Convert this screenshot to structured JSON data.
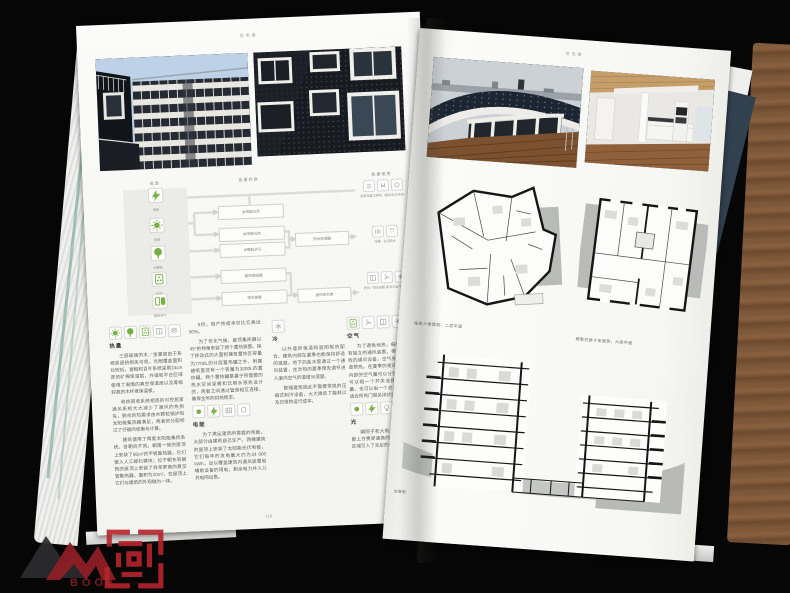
{
  "colors": {
    "accent_green": "#76b043",
    "seal_red": "#b5252b",
    "cover_navy": "#32414f",
    "wood_brown": "#7b5638",
    "plan_gray": "#b8bbb8"
  },
  "watermark": {
    "logo_text": "BOOK"
  },
  "book": {
    "left_page": {
      "header": "住宅楼",
      "page_number": "116",
      "photos": [
        {
          "name": "courtyard-facade-photo"
        },
        {
          "name": "dark-facade-photo"
        }
      ],
      "diagram": {
        "headers": [
          "能源",
          "能量转换",
          "能量使用"
        ],
        "sources": [
          {
            "icon": "lightning",
            "label": "电网"
          },
          {
            "icon": "sun",
            "label": "太阳"
          },
          {
            "icon": "tree",
            "label": "木颗粒"
          },
          {
            "icon": "pellet",
            "label": "地热"
          },
          {
            "icon": "exhaust",
            "label": "废弃空气"
          }
        ],
        "converters": [
          "太阳能光伏",
          "太阳能光热",
          "木颗粒炉子",
          "废热回收器",
          "排风装置"
        ],
        "storages": [
          "热水存储器",
          "通风热交换"
        ],
        "usages": [
          {
            "icons": [
              "grid-outline",
              "plug-outline",
              "circle-outline"
            ],
            "caption": "家用电器与照明（剩余电力并网）"
          },
          {
            "icons": [
              "radiator-outline",
              "shower-outline"
            ],
            "caption": "采暖 · 生活热水"
          },
          {
            "icons": [
              "window-outline",
              "fan-outline",
              "star-outline"
            ],
            "caption": "进风／排风装置 新风与废气热交换"
          }
        ]
      },
      "columns": [
        {
          "sections": [
            {
              "icons": [
                "sun",
                "tree",
                "pellet",
                "window-outline",
                "layers-outline"
              ],
              "title": "热量",
              "paragraphs": [
                "三层玻璃的木／金属窗由于系统原因热损失可观，光照覆盖面积比较低，窗框和百叶系统采用24cm厚的矿棉保温层，外墙和平台区域使用了周围的真空保温层以及等级较高的木纤维保温板。",
                "和热回收系统相连的可控居室通风系统大大减少了通风的热损失，剩余的热需求由木颗粒锅炉和太阳能集热器满足，两者的分配经过了仔细的权衡与计算。",
                "建筑使用了两套太阳能集热系统，各朝向不同。朝南一侧的屋顶上安装了95m²的平板集热器，它们嵌入人工蛭石模块；位于朝东和朝西的屋顶上安装了效率更高的真空管集热器，面积为20m²，在屋顶上它们与建筑的外观融为一体。"
              ]
            }
          ]
        },
        {
          "sections": [
            {
              "icons": [],
              "title": "",
              "paragraphs": [
                "5份，但产热成本仅比它高出50%。",
                "为了优化气候，屋顶集热器以45°的倾角安装了两个蓄热装置。除了移动式的大面积建筑蓄热区容量为7700L的分层蓄热罐之外，附属建筑里还有一个容量为3000L的蓄热罐。两个蓄热罐是基于所需要的热水空间采暖和饮用水预热设计的，两者之间通过管道相互连接，确保全年的供热稳定。"
              ]
            },
            {
              "icons": [
                "dot",
                "lightning",
                "pv-outline",
                "circle-outline"
              ],
              "title": "电能",
              "paragraphs": [
                "为了满足建筑所需要的电能，大部分由建筑自己生产。两幢建筑的屋顶上安装了太阳能光伏电板，它们每年的发电量大约为24 000 kWh，足以覆盖建筑内通风装置和辅助设备的用电，剩余电力并入公共电网出售。"
              ]
            }
          ]
        },
        {
          "sections": [
            {
              "icons": [
                "snow-outline"
              ],
              "title": "冷",
              "paragraphs": [
                "以外墙的保温和遮阳板的配合，建筑内部在夏季也能保持舒适的温度。地下的盐水管通过一个通风装置，在炎热的夏季预先调节进入室内空气的温度与湿度。",
                "整幢建筑因此不需要常规的压缩式制冷设备，大大降低了能耗以及日常的运行成本。"
              ]
            }
          ]
        },
        {
          "sections": [
            {
              "icons": [
                "pellet",
                "fan-outline",
                "window-outline",
                "star-outline"
              ],
              "title": "空气",
              "paragraphs": [
                "为了避免地热，每幢建筑都设有独立的通风装置，带有高效热回收的通风设备，空气先进入地下风道预热。在夏季的夜间，各户建筑内部的空气量可以分别调节，住户可以用一个开关选择所需的通风量，也可以由一个总开关设置一个适合所有门窗关闭状态的通风量。"
              ]
            },
            {
              "icons": [
                "dot",
                "lightning",
                "bulb-outline"
              ],
              "title": "光",
              "paragraphs": [
                "朝院子和大街上的大窗和内走廊上方贯穿通高的屋顶天窗为公共区域引入了充足的自然采光。"
              ]
            }
          ]
        }
      ]
    },
    "right_page": {
      "header": "住宅楼",
      "photos": [
        {
          "name": "solar-roof-terrace-photo"
        },
        {
          "name": "kitchen-interior-photo"
        }
      ],
      "plans": [
        {
          "caption": "临街大楼建筑，二层平面"
        },
        {
          "caption": "穆勒巴赫大街建筑，六层平面"
        }
      ],
      "section_caption": "剖面图"
    }
  }
}
